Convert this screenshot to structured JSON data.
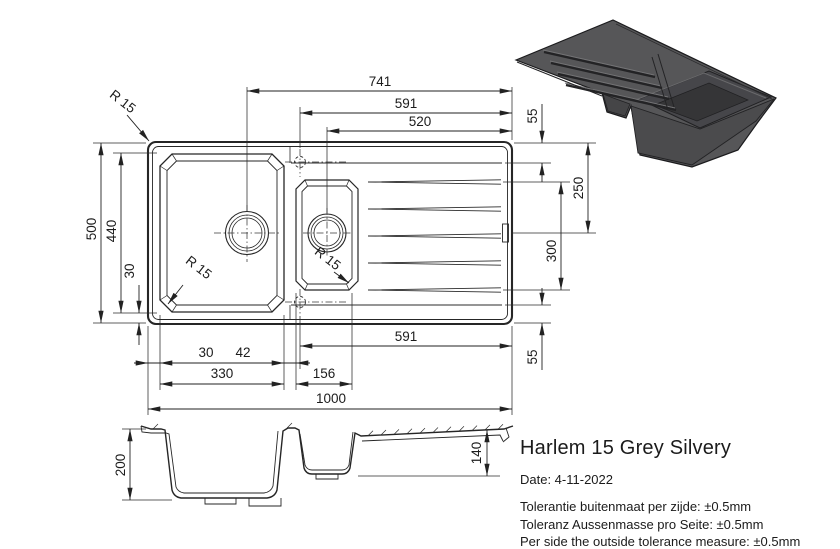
{
  "product": {
    "title": "Harlem 15 Grey Silvery",
    "date": "Date: 4-11-2022"
  },
  "tolerances": {
    "nl": "Tolerantie buitenmaat per zijde: ±0.5mm",
    "de": "Toleranz Aussenmasse pro Seite: ±0.5mm",
    "en": "Per side the outside tolerance measure: ±0.5mm"
  },
  "dims": {
    "t741": "741",
    "t591": "591",
    "t520": "520",
    "r55_top": "55",
    "r250": "250",
    "r300": "300",
    "r55_bottom": "55",
    "l500": "500",
    "l440": "440",
    "l30": "30",
    "b30": "30",
    "b42": "42",
    "b330": "330",
    "b156": "156",
    "b591": "591",
    "b1000": "1000",
    "s200": "200",
    "s140": "140",
    "radius": "R 15"
  },
  "drawing_info": {
    "units": "mm",
    "views": [
      "top-plan",
      "front-section",
      "isometric-render"
    ],
    "overall_length": 1000,
    "overall_width": 500,
    "main_bowl_depth": 200,
    "small_bowl_depth": 140,
    "corner_radius": 15
  }
}
